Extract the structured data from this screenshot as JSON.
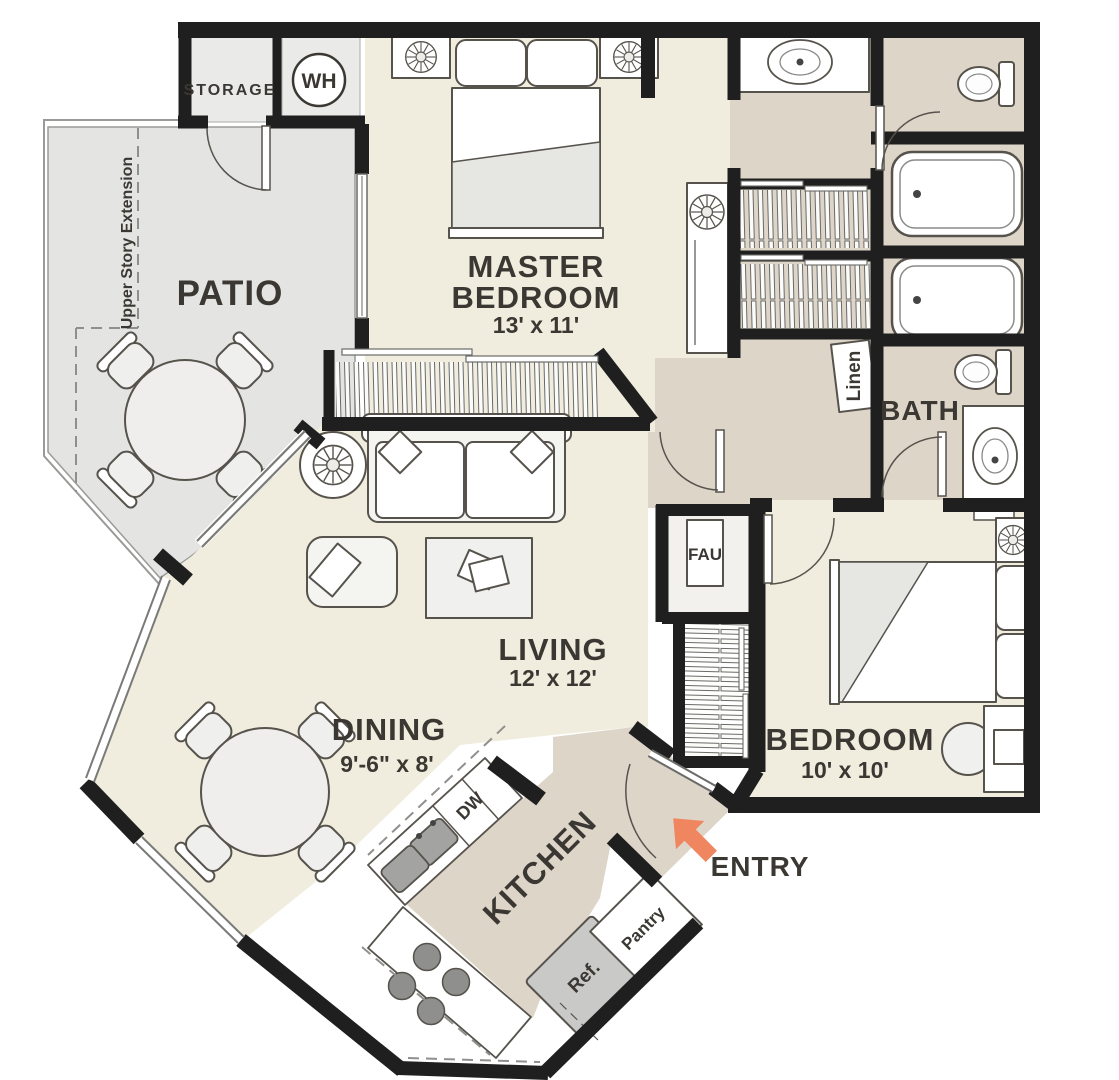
{
  "title": "Two Bedroom Apartment Floor Plan",
  "colors": {
    "wall": "#1f1f1f",
    "floor_main": "#f1edde",
    "floor_hall": "#ded5c9",
    "floor_patio": "#e4e4e2",
    "entry_arrow": "#ef8660",
    "label_text": "#3b3833"
  },
  "rooms": {
    "patio": {
      "label": "PATIO"
    },
    "storage": {
      "label": "STORAGE"
    },
    "water_heater": {
      "label": "WH"
    },
    "upper_story": {
      "label": "Upper Story Extension"
    },
    "master_bedroom": {
      "label_line1": "MASTER",
      "label_line2": "BEDROOM",
      "dims": "13' x 11'"
    },
    "living": {
      "label": "LIVING",
      "dims": "12' x 12'"
    },
    "dining": {
      "label": "DINING",
      "dims": "9'-6\" x 8'"
    },
    "kitchen": {
      "label": "KITCHEN"
    },
    "bedroom": {
      "label": "BEDROOM",
      "dims": "10' x 10'"
    },
    "bath": {
      "label": "BATH"
    },
    "entry": {
      "label": "ENTRY"
    },
    "linen": {
      "label": "Linen"
    },
    "fau": {
      "label": "FAU"
    }
  },
  "appliances": {
    "dishwasher": {
      "label": "DW"
    },
    "refrigerator": {
      "label": "Ref."
    },
    "pantry": {
      "label": "Pantry"
    }
  }
}
